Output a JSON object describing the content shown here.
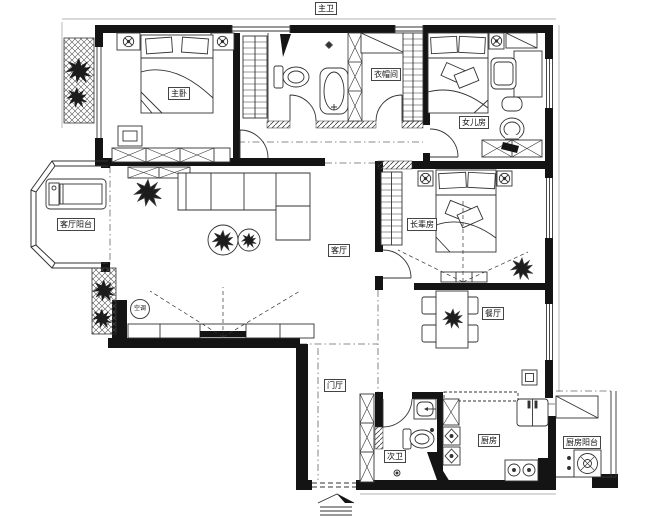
{
  "colors": {
    "background": "#ffffff",
    "line": "#333333",
    "wall": "#141414"
  },
  "rooms": {
    "master_bedroom": {
      "label": "主卧"
    },
    "master_bathroom": {
      "label": "主卫"
    },
    "cloakroom": {
      "label": "衣帽间"
    },
    "daughter_room": {
      "label": "女儿房"
    },
    "living_room": {
      "label": "客厅"
    },
    "living_balcony": {
      "label": "客厅阳台"
    },
    "elder_room": {
      "label": "长辈房"
    },
    "dining_room": {
      "label": "餐厅"
    },
    "foyer": {
      "label": "门厅"
    },
    "second_bathroom": {
      "label": "次卫"
    },
    "kitchen": {
      "label": "厨房"
    },
    "kitchen_balcony": {
      "label": "厨房阳台"
    }
  },
  "symbols": {
    "ac_unit_label": "空调",
    "furniture": {
      "master_bedroom": [
        "double-bed",
        "nightstands",
        "wardrobe",
        "dresser",
        "tv"
      ],
      "master_bathroom": [
        "toilet",
        "bathtub",
        "faucet"
      ],
      "cloakroom": [
        "hanging-rail",
        "shelf",
        "storage-column"
      ],
      "daughter_room": [
        "single-bed",
        "desk",
        "chair",
        "dresser",
        "tv"
      ],
      "living_room": [
        "l-sofa",
        "coffee-tables",
        "tv-cabinet",
        "plants"
      ],
      "living_balcony": [
        "treadmill",
        "planters"
      ],
      "elder_room": [
        "double-bed",
        "wardrobe",
        "tv-cabinet",
        "plant"
      ],
      "dining_room": [
        "dining-table",
        "four-chairs",
        "plant"
      ],
      "foyer": [
        "shoe-cabinet",
        "entry-steps"
      ],
      "second_bathroom": [
        "toilet",
        "sink",
        "floor-drain"
      ],
      "kitchen": [
        "fridge",
        "stove",
        "cabinets"
      ],
      "kitchen_balcony": [
        "washing-machine",
        "cabinet"
      ]
    }
  }
}
